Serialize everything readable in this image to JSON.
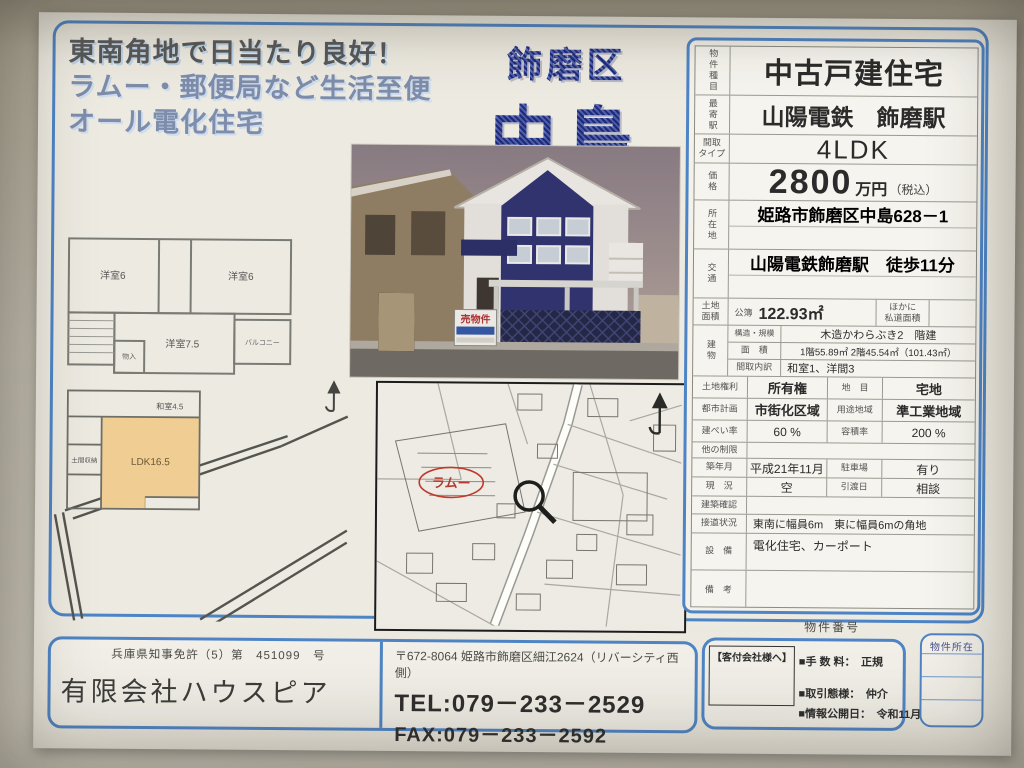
{
  "colors": {
    "accent_blue": "#4d84c6",
    "title_navy": "#27337f",
    "lattice_navy": "#20265c",
    "map_red": "#c0392b"
  },
  "flyer": {
    "catchcopy": {
      "line1": "東南角地で日当たり良好！",
      "line2": "ラムー・郵便局など生活至便",
      "line3": "オール電化住宅"
    },
    "title": {
      "district": "飾磨区",
      "name": "中島"
    },
    "photo": {
      "sign": "売物件"
    },
    "plan2f": {
      "room_a": "洋室6",
      "room_b": "洋室6",
      "room_c": "洋室7.5",
      "balcony": "バルコニー",
      "closet": "物入"
    },
    "plan1f": {
      "ldk": "LDK16.5",
      "washitsu": "和室4.5",
      "doma": "土間収納"
    },
    "map": {
      "store": "ラムー"
    },
    "property_no_caption": "物件番号"
  },
  "spec": {
    "property_type": {
      "label": "物件種目",
      "value": "中古戸建住宅"
    },
    "station": {
      "label": "最寄駅",
      "value": "山陽電鉄　飾磨駅"
    },
    "layout": {
      "label": "間取\nタイプ",
      "value": "4LDK"
    },
    "price": {
      "label": "価格",
      "value": "2800",
      "unit": "万円",
      "tax": "（税込）"
    },
    "location": {
      "label": "所在地",
      "value": "姫路市飾磨区中島628－1"
    },
    "access": {
      "label": "交通",
      "value": "山陽電鉄飾磨駅　徒歩11分"
    },
    "land": {
      "label": "土地\n面積",
      "register": "公簿",
      "value": "122.93㎡",
      "note": "ほかに\n私道面積"
    },
    "building": {
      "label": "建物",
      "structure": {
        "label": "構造・規模",
        "value": "木造かわらぶき2　階建"
      },
      "area": {
        "label": "面　積",
        "value": "1階55.89㎡ 2階45.54㎡（101.43㎡）"
      },
      "rooms": {
        "label": "間取内訳",
        "value": "和室1、洋間3"
      }
    },
    "land_right": {
      "label": "土地権利",
      "value": "所有権"
    },
    "land_cat": {
      "label": "地　目",
      "value": "宅地"
    },
    "city_plan": {
      "label": "都市計画",
      "value": "市街化区域"
    },
    "zoning": {
      "label": "用途地域",
      "value": "準工業地域"
    },
    "coverage": {
      "label": "建ぺい率",
      "value": "60 %"
    },
    "far": {
      "label": "容積率",
      "value": "200 %"
    },
    "other": {
      "label": "他の制限",
      "value": ""
    },
    "built": {
      "label": "築年月",
      "value": "平成21年11月"
    },
    "parking": {
      "label": "駐車場",
      "value": "有り"
    },
    "status": {
      "label": "現　況",
      "value": "空"
    },
    "handover": {
      "label": "引渡日",
      "value": "相談"
    },
    "confirm": {
      "label": "建築確認",
      "value": ""
    },
    "road": {
      "label": "接道状況",
      "value": "東南に幅員6m　東に幅員6mの角地"
    },
    "equipment": {
      "label": "設　備",
      "value": "電化住宅、カーポート"
    },
    "remarks": {
      "label": "備　考",
      "value": ""
    },
    "member_no": {
      "label": "会員番号",
      "value": ""
    },
    "property_no": {
      "label": "物件番号",
      "value": ""
    }
  },
  "footer": {
    "license": "兵庫県知事免許（5）第　451099　号",
    "company": "有限会社ハウスピア",
    "address": "〒672-8064 姫路市飾磨区細江2624（リバーシティ西側）",
    "tel": "TEL:079－233－2529",
    "fax": "FAX:079－233－2592",
    "agent_header": "【客付会社様へ】",
    "fee": "■手 数 料：　正規",
    "transaction": "■取引態様：　仲介",
    "published": "■情報公開日：　令和11月",
    "location_box": "物件所在"
  }
}
